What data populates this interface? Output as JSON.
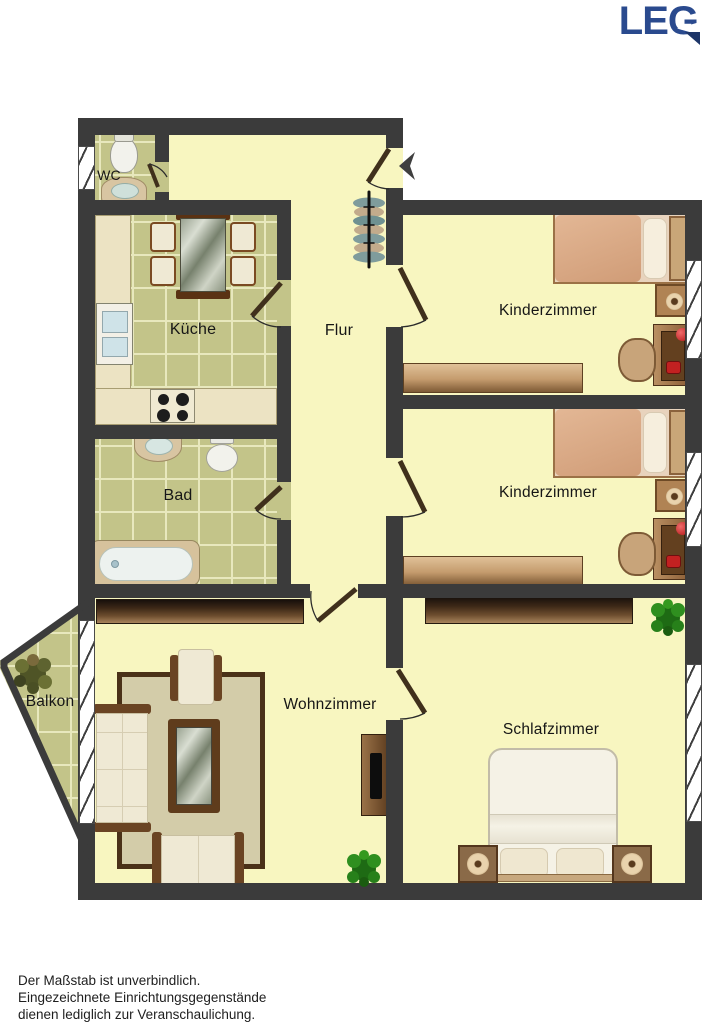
{
  "logo": {
    "text": "LEG",
    "color": "#2a4a8e"
  },
  "rooms": [
    {
      "id": "wc",
      "label": "WC",
      "furniture": [
        "toilet",
        "sink"
      ]
    },
    {
      "id": "kueche",
      "label": "Küche",
      "furniture": [
        "dining-table",
        "chairs",
        "sink",
        "stove",
        "counter"
      ]
    },
    {
      "id": "flur",
      "label": "Flur",
      "furniture": [
        "coat-rack"
      ]
    },
    {
      "id": "kinderzimmer-oben",
      "label": "Kinderzimmer",
      "furniture": [
        "bed",
        "nightstand",
        "desk",
        "desk-chair",
        "sideboard"
      ]
    },
    {
      "id": "kinderzimmer-unten",
      "label": "Kinderzimmer",
      "furniture": [
        "bed",
        "nightstand",
        "desk",
        "desk-chair",
        "sideboard"
      ]
    },
    {
      "id": "bad",
      "label": "Bad",
      "furniture": [
        "sink",
        "toilet",
        "bathtub"
      ]
    },
    {
      "id": "balkon",
      "label": "Balkon",
      "furniture": [
        "plant"
      ]
    },
    {
      "id": "wohnzimmer",
      "label": "Wohnzimmer",
      "furniture": [
        "sideboard",
        "sofa",
        "armchair",
        "loveseat",
        "coffee-table",
        "rug",
        "tv-cabinet",
        "plant"
      ]
    },
    {
      "id": "schlafzimmer",
      "label": "Schlafzimmer",
      "furniture": [
        "wardrobe",
        "double-bed",
        "nightstand-left",
        "nightstand-right",
        "plant"
      ]
    }
  ],
  "entrance": {
    "symbol": "arrow-left"
  },
  "disclaimer": {
    "line1": "Der Maßstab ist unverbindlich.",
    "line2": "Eingezeichnete Einrichtungsgegenstände",
    "line3": "dienen lediglich zur Veranschaulichung."
  },
  "colors": {
    "wall": "#3b3b3b",
    "floor": "#f8f6c0",
    "tile": "#c3c489",
    "logo": "#2a4a8e"
  }
}
